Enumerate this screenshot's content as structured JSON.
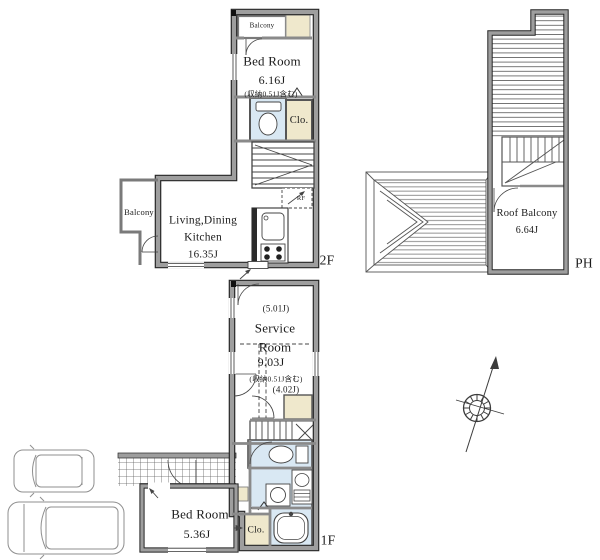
{
  "colors": {
    "wall": "#9e9e9e",
    "wall_edge": "#262626",
    "wet_area": "#d9e8f3",
    "storage": "#efe8cc",
    "paper": "#ffffff",
    "line": "#3a3a3a",
    "text": "#1b1b1b"
  },
  "floor2": {
    "floor_label": "2F",
    "balcony_top": "Balcony",
    "balcony_left": "Balcony",
    "bedroom": {
      "name": "Bed Room",
      "size": "6.16J",
      "note": "(収納0.51J含む)"
    },
    "closet_label": "Clo.",
    "refrigerator_label": "RF",
    "ldk": {
      "line1": "Living,Dining",
      "line2": "Kitchen",
      "size": "16.35J"
    }
  },
  "penthouse": {
    "floor_label": "PH",
    "roof_balcony": {
      "name": "Roof Balcony",
      "size": "6.64J"
    }
  },
  "floor1": {
    "floor_label": "1F",
    "service_room": {
      "upper_size": "(5.01J)",
      "name_line1": "Service",
      "name_line2": "Room",
      "size": "9.03J",
      "note": "(収納0.51J含む)",
      "lower_size": "(4.02J)"
    },
    "bedroom": {
      "name": "Bed Room",
      "size": "5.36J"
    },
    "closet_label": "Clo."
  }
}
